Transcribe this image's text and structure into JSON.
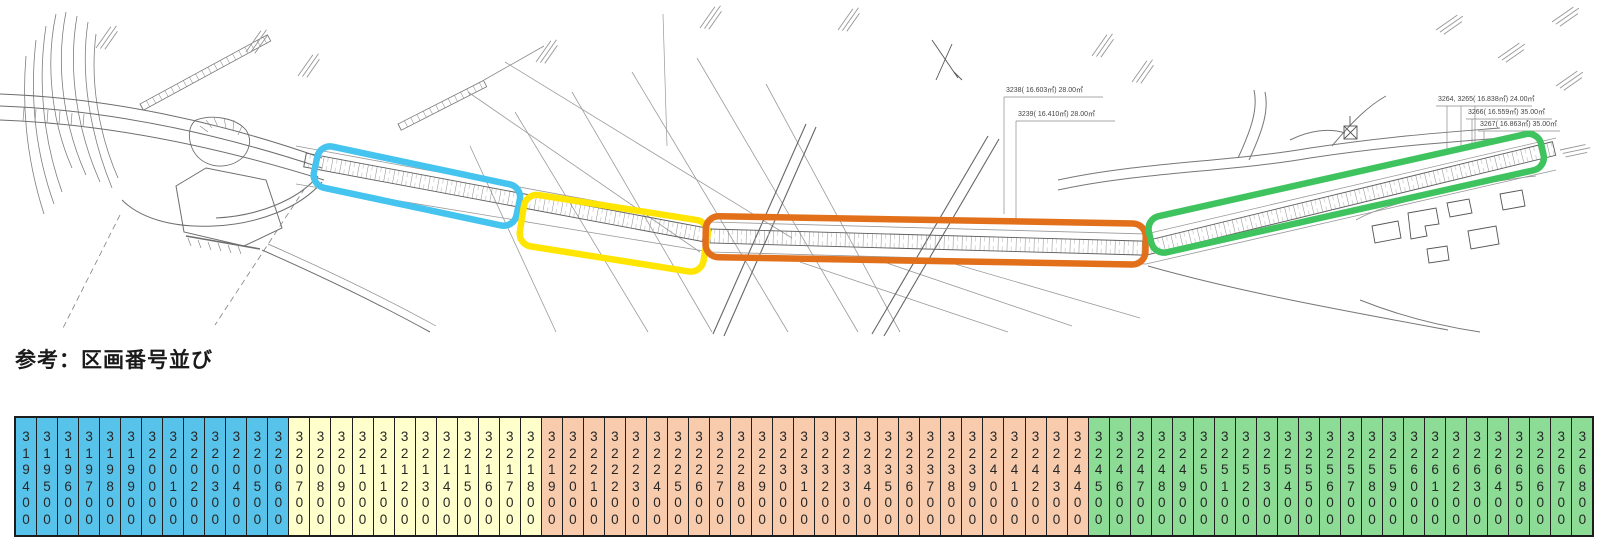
{
  "title": "参考：区画番号並び",
  "map": {
    "highlight_boxes": [
      {
        "name": "section-blue",
        "color": "#45C4EF"
      },
      {
        "name": "section-yellow",
        "color": "#FFE500"
      },
      {
        "name": "section-orange",
        "color": "#E2701A"
      },
      {
        "name": "section-green",
        "color": "#3FC35F"
      }
    ],
    "annotations": [
      {
        "text": "3238( 16.603㎡) 28.00㎡",
        "x": 1004,
        "y": 97
      },
      {
        "text": "3239( 16.410㎡) 28.00㎡",
        "x": 1016,
        "y": 121
      },
      {
        "text": "3264, 3265( 16.838㎡) 24.00㎡",
        "x": 1436,
        "y": 106
      },
      {
        "text": "3266( 16.559㎡) 35.00㎡",
        "x": 1466,
        "y": 119
      },
      {
        "text": "3267( 16.863㎡) 35.00㎡",
        "x": 1478,
        "y": 131
      }
    ]
  },
  "table": {
    "segments": [
      {
        "name": "blue",
        "bg": "#58C3EA",
        "numbers": [
          "319400",
          "319500",
          "319600",
          "319700",
          "319800",
          "319900",
          "320000",
          "320100",
          "320200",
          "320300",
          "320400",
          "320500",
          "320600"
        ]
      },
      {
        "name": "yellow",
        "bg": "#FFFFCC",
        "numbers": [
          "320700",
          "320800",
          "320900",
          "321000",
          "321100",
          "321200",
          "321300",
          "321400",
          "321500",
          "321600",
          "321700",
          "321800"
        ]
      },
      {
        "name": "orange",
        "bg": "#F8CBAD",
        "numbers": [
          "321900",
          "322000",
          "322100",
          "322200",
          "322300",
          "322400",
          "322500",
          "322600",
          "322700",
          "322800",
          "322900",
          "323000",
          "323100",
          "323200",
          "323300",
          "323400",
          "323500",
          "323600",
          "323700",
          "323800",
          "323900",
          "324000",
          "324100",
          "324200",
          "324300",
          "324400"
        ]
      },
      {
        "name": "green",
        "bg": "#8CDC96",
        "numbers": [
          "324500",
          "324600",
          "324700",
          "324800",
          "324900",
          "325000",
          "325100",
          "325200",
          "325300",
          "325400",
          "325500",
          "325600",
          "325700",
          "325800",
          "325900",
          "326000",
          "326100",
          "326200",
          "326300",
          "326400",
          "326500",
          "326600",
          "326700",
          "326800"
        ]
      }
    ]
  }
}
